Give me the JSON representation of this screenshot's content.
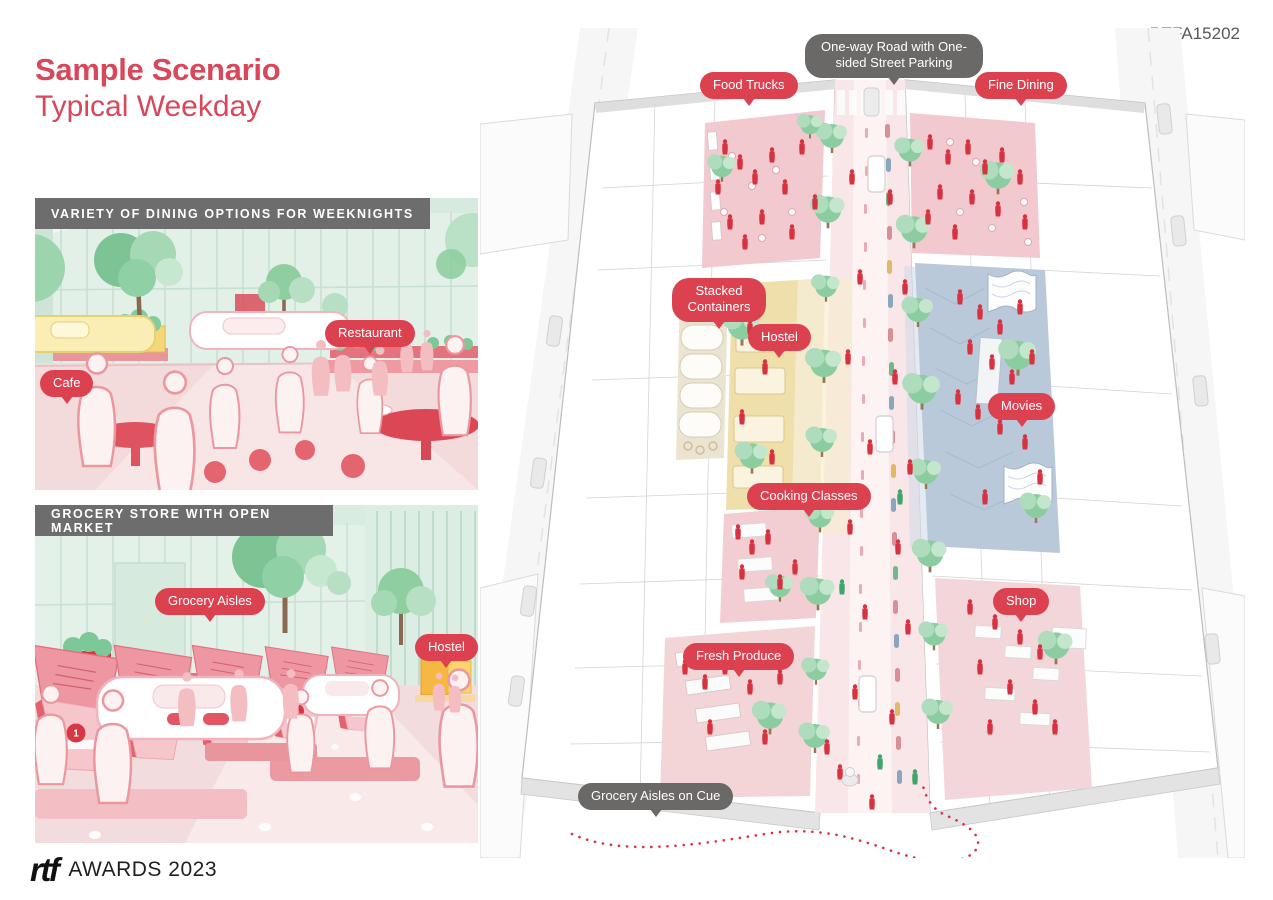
{
  "header": {
    "project_code": "RTFA15202"
  },
  "title": {
    "line1": "Sample Scenario",
    "line2": "Typical Weekday"
  },
  "panels": {
    "dining": {
      "header": "VARIETY OF DINING OPTIONS FOR WEEKNIGHTS",
      "labels": {
        "restaurant": "Restaurant",
        "cafe": "Cafe"
      }
    },
    "grocery": {
      "header": "GROCERY STORE WITH OPEN MARKET",
      "labels": {
        "grocery_aisles": "Grocery Aisles",
        "hostel": "Hostel"
      },
      "stall_numbers": [
        "1",
        "2",
        "3",
        "4",
        "5"
      ]
    }
  },
  "main": {
    "labels": {
      "road": "One-way Road with One-sided Street Parking",
      "food_trucks": "Food Trucks",
      "fine_dining": "Fine Dining",
      "stacked_containers": "Stacked Containers",
      "hostel": "Hostel",
      "movies": "Movies",
      "cooking_classes": "Cooking Classes",
      "shop": "Shop",
      "fresh_produce": "Fresh Produce",
      "grocery_cue": "Grocery Aisles on Cue"
    }
  },
  "footer": {
    "logo": "rtf",
    "label": "AWARDS 2023"
  },
  "colors": {
    "accent_red": "#dc4150",
    "title_red": "#d8475a",
    "label_gray": "#6b6868",
    "header_bar_gray": "#6d6d6d",
    "code_gray": "#58595b",
    "tree_green": "#8bcda0",
    "street_pink": "#f8e6e8",
    "movies_blue": "#b9c9d9",
    "hostel_yellow": "#eedfab",
    "people_red": "#d6323f"
  }
}
